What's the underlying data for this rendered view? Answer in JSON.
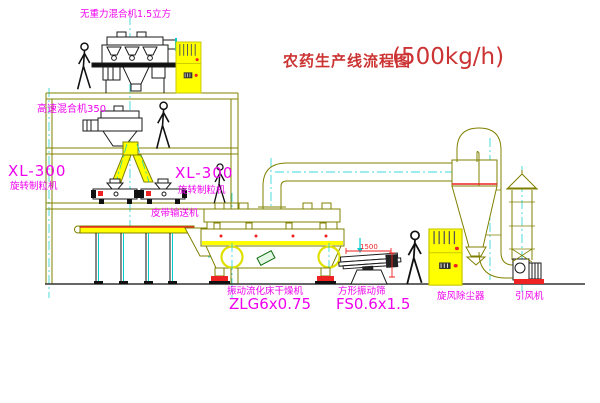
{
  "title": {
    "name": "农药生产线流程图",
    "capacity": "(500kg/h)"
  },
  "labels": {
    "gravity_mixer": "无重力混合机1.5立方",
    "high_speed_mixer": "高速混合机350",
    "granulator_left_model": "XL-300",
    "granulator_left": "旋转制粒机",
    "granulator_mid_model": "XL-300",
    "granulator_mid": "旋转制粒机",
    "belt_conveyor": "皮带输送机",
    "fluid_bed_dryer": "振动流化床干燥机",
    "fluid_bed_dryer_model": "ZLG6x0.75",
    "vibrating_screen": "方形振动筛",
    "vibrating_screen_model": "FS0.6x1.5",
    "cyclone": "旋风除尘器",
    "induced_draft_fan": "引风机",
    "dim_1500": "1500"
  },
  "colors": {
    "line_olive": "#808000",
    "label_magenta": "#ee00ee",
    "title_red": "#cc3333",
    "accent_red": "#ee2222",
    "centerline_cyan": "#00cccc",
    "equipment_yellow": "#ffff00",
    "machine_black": "#1a1a1a",
    "background": "#ffffff"
  }
}
